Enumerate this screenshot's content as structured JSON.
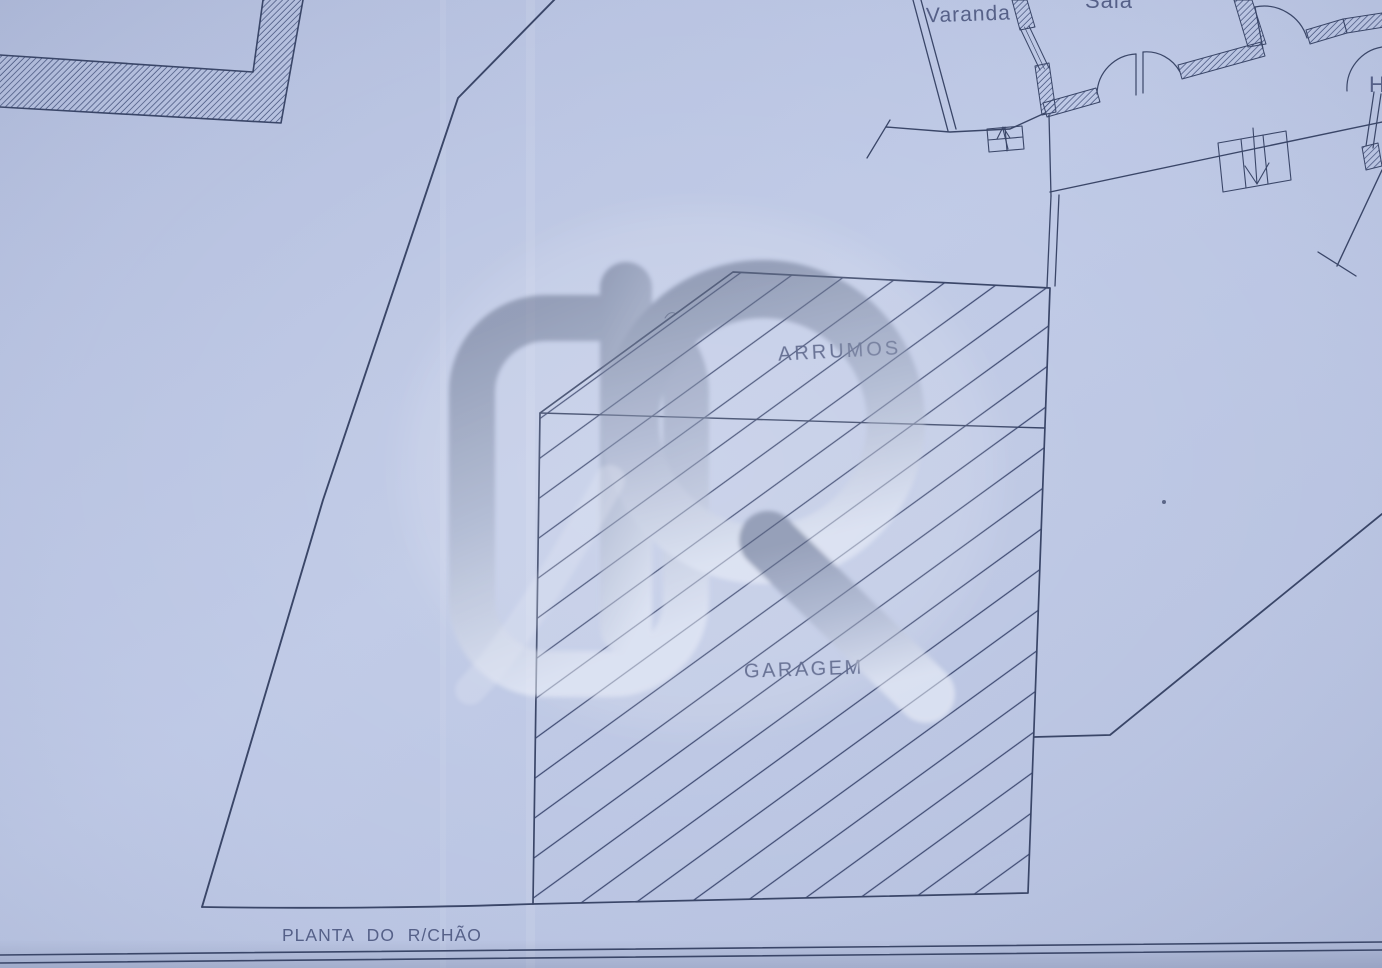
{
  "plan": {
    "caption": "PLANTA DO R/CHÃO",
    "labels": {
      "varanda": "Varanda",
      "sala": "Sala",
      "hall": "H",
      "arrumos": "ARRUMOS",
      "garagem": "GARAGEM"
    },
    "watermark": {
      "letter": "R"
    },
    "colors": {
      "paper": "#b8c3e1",
      "ink": "#3a4668",
      "hatch": "#3f4b73",
      "label_text": "#4d5880",
      "watermark_dark": "#6e7890",
      "watermark_light": "#f4f7fd"
    }
  }
}
